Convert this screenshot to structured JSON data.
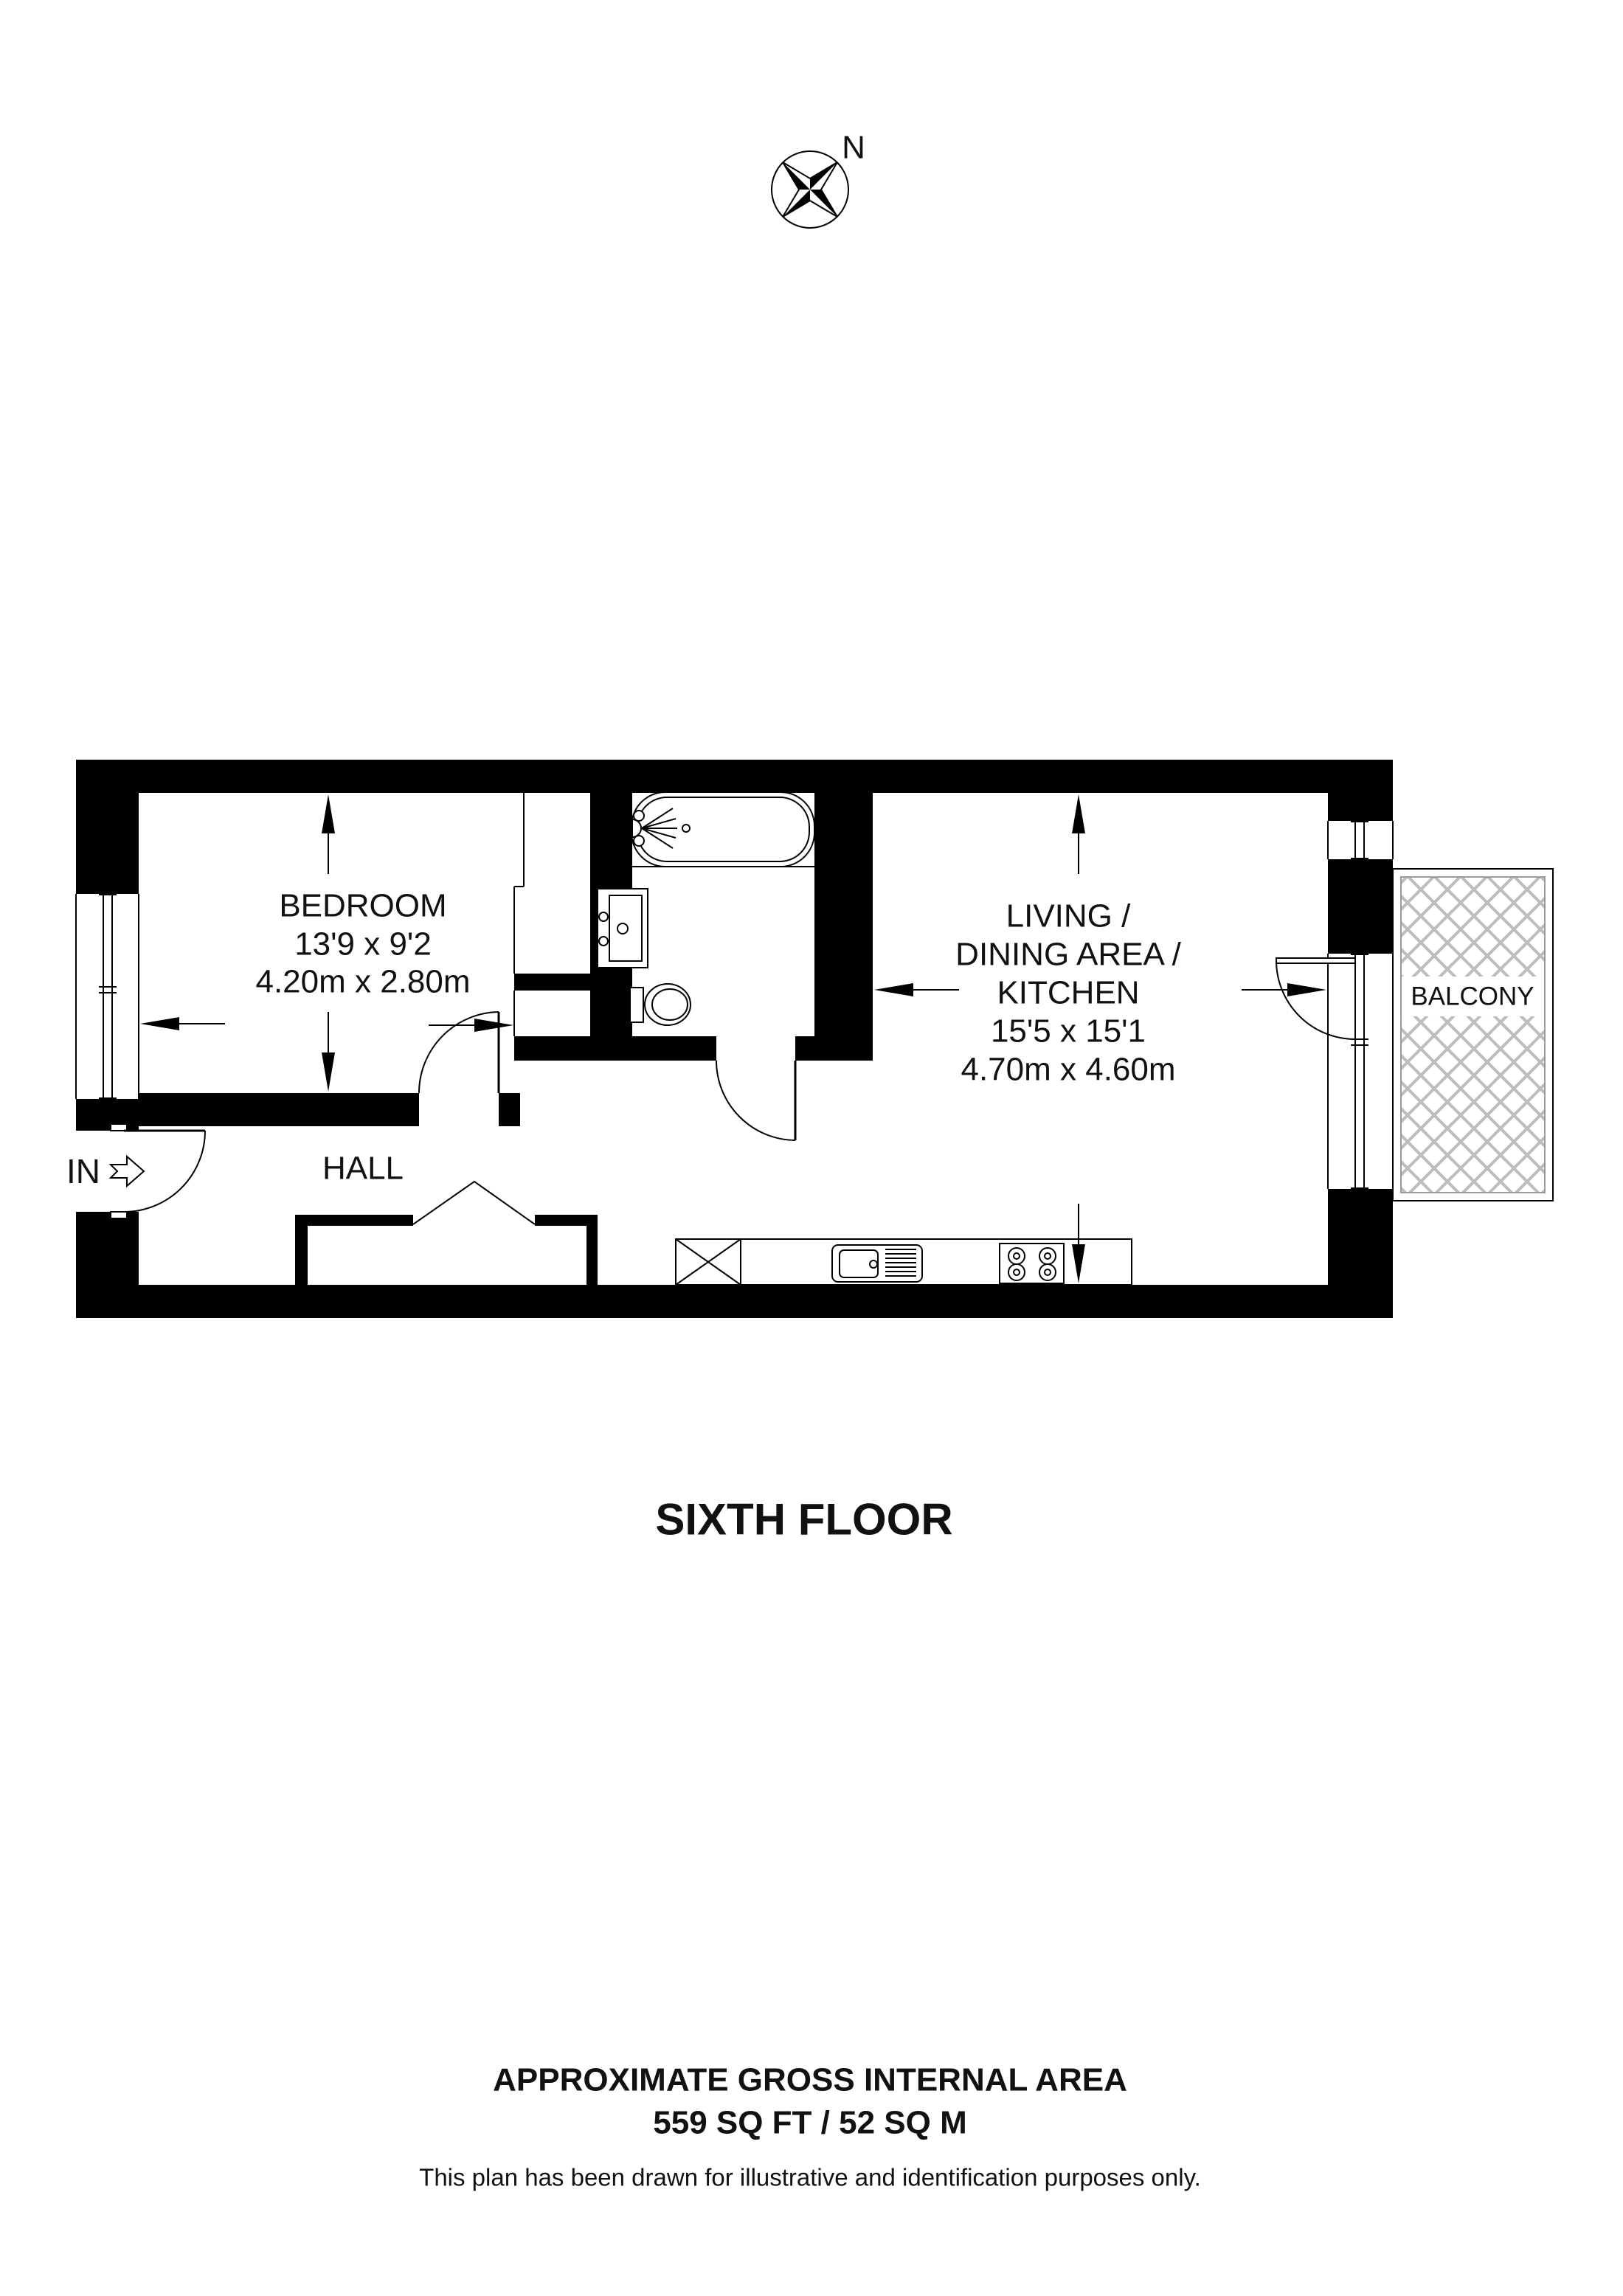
{
  "compass": {
    "north_label": "N"
  },
  "floor_title": "SIXTH FLOOR",
  "entrance": {
    "label": "IN"
  },
  "rooms": {
    "bedroom": {
      "name": "BEDROOM",
      "size_imperial": "13'9 x 9'2",
      "size_metric": "4.20m x 2.80m"
    },
    "living": {
      "name_line1": "LIVING /",
      "name_line2": "DINING AREA /",
      "name_line3": "KITCHEN",
      "size_imperial": "15'5 x 15'1",
      "size_metric": "4.70m x 4.60m"
    },
    "hall": {
      "name": "HALL"
    },
    "balcony": {
      "name": "BALCONY"
    }
  },
  "footer": {
    "area_title": "APPROXIMATE GROSS INTERNAL AREA",
    "area_value": "559 SQ FT / 52 SQ M",
    "disclaimer": "This plan has been drawn for illustrative and identification purposes only."
  },
  "colors": {
    "wall": "#000000",
    "hatch": "#bdbdbd",
    "background": "#ffffff"
  }
}
